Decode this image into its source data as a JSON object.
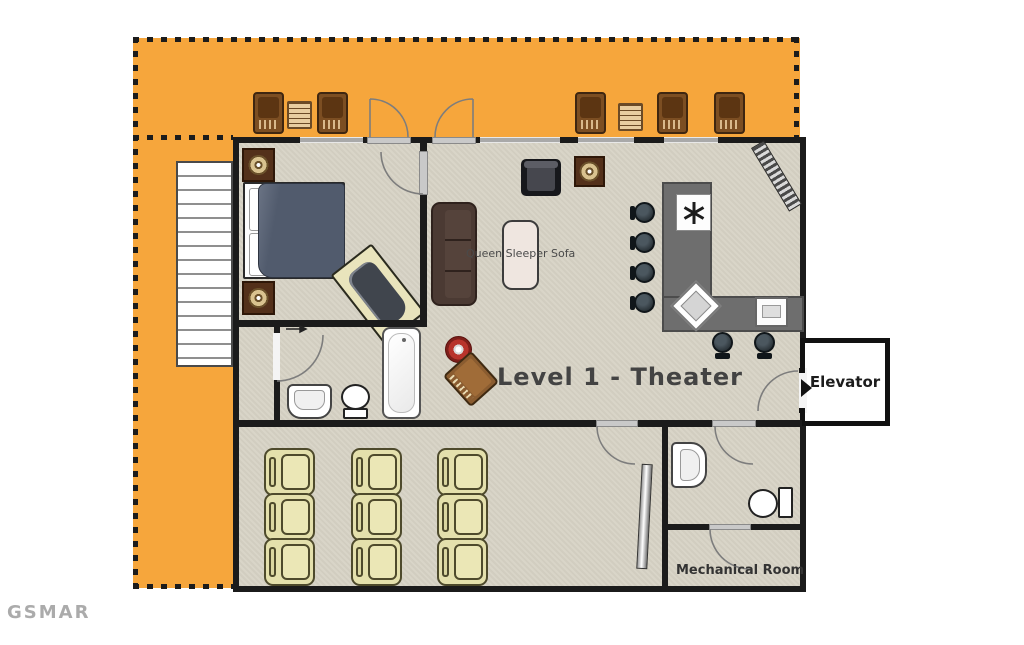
{
  "title": "Level 1 - Theater floor plan",
  "labels": {
    "level_title": "Level 1 - Theater",
    "queen_sofa": "Queen Sleeper Sofa",
    "elevator": "Elevator",
    "mechanical_room": "Mechanical Room",
    "watermark": "GSMAR"
  },
  "colors": {
    "deck": "#F6A63C",
    "floor": "#D9D5C8",
    "wall": "#1B1B1B",
    "counter": "#6E6E6E",
    "recliner": "#E4E0AC",
    "recliner-border": "#4E4A2C",
    "sofa": "#4B3A33",
    "bed": "#515B6D",
    "tub-platform": "#E9E4BC",
    "accent-red": "#B8342C",
    "text-dark": "#434343"
  },
  "furniture": {
    "deck": {
      "lounge_chairs": 5,
      "side_tables": 2,
      "exterior_stairs": 1
    },
    "bedroom": {
      "bed": 1,
      "nightstands_with_lamps": 2,
      "jetted_tub": 1
    },
    "bathroom": {
      "sink": 1,
      "toilet": 1,
      "bathtub": 1
    },
    "living_area": {
      "armchair": 1,
      "table_lamp": 1,
      "sofa": 1,
      "sleeper_mattress": 1,
      "wood_chair": 1,
      "red_stool": 1
    },
    "bar": {
      "cooktop": 1,
      "bar_sink": 1,
      "appliance": 1,
      "bar_stools": 6
    },
    "theater": {
      "recliners": 9,
      "screen": 1
    },
    "half_bath": {
      "sink": 1,
      "toilet": 1
    },
    "elevator": 1
  }
}
